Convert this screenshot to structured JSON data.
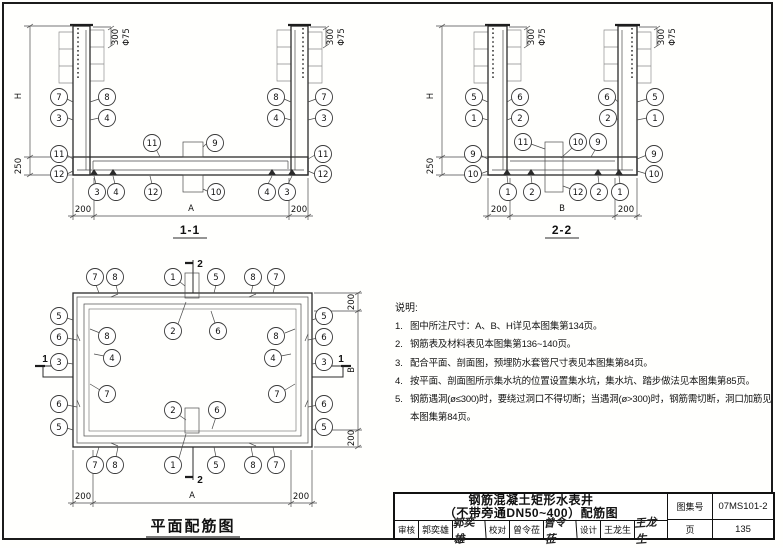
{
  "sections": {
    "s11": {
      "caption": "1-1",
      "callouts": [
        "7",
        "8",
        "3",
        "4",
        "11",
        "12",
        "11",
        "9",
        "10",
        "3",
        "4",
        "12",
        "8",
        "7",
        "4",
        "3",
        "11",
        "12",
        "4",
        "3"
      ],
      "dims": {
        "h": "H",
        "d250": "250",
        "left": "200",
        "mid": "A",
        "right": "200"
      },
      "ann": {
        "d300": "300",
        "d75": "Φ75"
      }
    },
    "s22": {
      "caption": "2-2",
      "callouts": [
        "5",
        "6",
        "1",
        "2",
        "11",
        "10",
        "9",
        "9",
        "10",
        "6",
        "5",
        "2",
        "1",
        "9",
        "10",
        "1",
        "2",
        "12",
        "2",
        "1"
      ],
      "dims": {
        "h": "H",
        "d250": "250",
        "left": "200",
        "mid": "B",
        "right": "200"
      },
      "ann": {
        "d300": "300",
        "d75": "Φ75"
      }
    },
    "plan": {
      "caption": "平面配筋图",
      "top_row": [
        "7",
        "8",
        "1",
        "5",
        "8",
        "7"
      ],
      "left_col": [
        "5",
        "6",
        "3",
        "6",
        "5"
      ],
      "inner_left": [
        "8",
        "4",
        "7"
      ],
      "inner_top": [
        "2",
        "6"
      ],
      "inner_bottom": [
        "2",
        "6"
      ],
      "inner_right": [
        "8",
        "4",
        "7"
      ],
      "right_col": [
        "5",
        "6",
        "3",
        "6",
        "5"
      ],
      "bottom_row": [
        "7",
        "8",
        "1",
        "5",
        "8",
        "7"
      ],
      "section_marker_1": "1",
      "section_marker_2": "2",
      "dims": {
        "right_top": "200",
        "right_mid": "B",
        "right_bottom": "200",
        "bottom_left": "200",
        "bottom_mid": "A",
        "bottom_right": "200"
      }
    }
  },
  "notes": {
    "heading": "说明:",
    "items": [
      {
        "num": "1.",
        "text": "图中所注尺寸：A、B、H详见本图集第134页。"
      },
      {
        "num": "2.",
        "text": "钢筋表及材料表见本图集第136~140页。"
      },
      {
        "num": "3.",
        "text": "配合平面、剖面图，预埋防水套管尺寸表见本图集第84页。"
      },
      {
        "num": "4.",
        "text": "按平面、剖面图所示集水坑的位置设置集水坑，集水坑、踏步做法见本图集第85页。"
      },
      {
        "num": "5.",
        "text": "钢筋遇洞(ø≤300)时，要绕过洞口不得切断；当遇洞(ø>300)时，钢筋需切断，洞口加筋见本图集第84页。"
      }
    ]
  },
  "title_block": {
    "title_line1": "钢筋混凝土矩形水表井",
    "title_line2": "（不带旁通DN50~400）配筋图",
    "atlas_label": "图集号",
    "atlas_number": "07MS101-2",
    "page_label": "页",
    "page_number": "135",
    "reviewer_label": "审核",
    "reviewer_name": "郭奕雄",
    "reviewer_signature": "郭奕雄",
    "checker_label": "校对",
    "checker_name": "曾令莅",
    "checker_signature": "曾令莅",
    "designer_label": "设计",
    "designer_name": "王龙生",
    "designer_signature": "王龙生"
  }
}
